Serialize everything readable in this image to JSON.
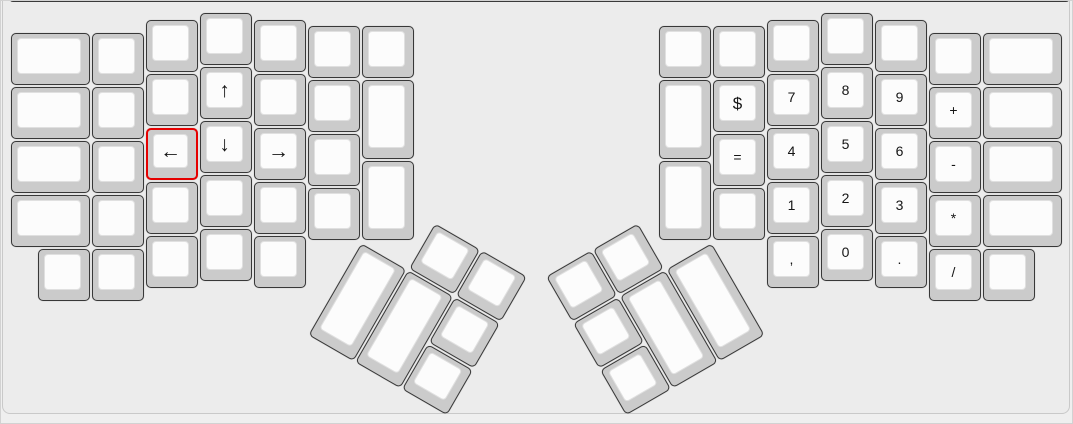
{
  "app": {
    "description_label": "ergodox-keyboard-layout-canvas",
    "selected_key_label": "←"
  },
  "colors": {
    "page_bg": "#efefef",
    "canvas_bg": "#ececec",
    "canvas_border": "#c9c9c9",
    "toolbar_edge_line": "#3a3a3a",
    "key_side": "#cbcbcb",
    "key_side_border": "#383838",
    "key_top": "#fcfcfc",
    "selection_red": "#e60000",
    "label_color": "#151515"
  },
  "keyboard": {
    "unit": 54,
    "main_keys": [
      {
        "x": 10,
        "y": 32,
        "w": 81
      },
      {
        "x": 10,
        "y": 86,
        "w": 81
      },
      {
        "x": 10,
        "y": 140,
        "w": 81
      },
      {
        "x": 10,
        "y": 194,
        "w": 81
      },
      {
        "x": 91,
        "y": 32
      },
      {
        "x": 91,
        "y": 86
      },
      {
        "x": 91,
        "y": 140
      },
      {
        "x": 91,
        "y": 194
      },
      {
        "x": 37,
        "y": 248
      },
      {
        "x": 91,
        "y": 248
      },
      {
        "x": 145,
        "y": 19
      },
      {
        "x": 145,
        "y": 73
      },
      {
        "x": 145,
        "y": 127,
        "label": "←",
        "name": "left-arrow",
        "size": "lg",
        "selected": true
      },
      {
        "x": 145,
        "y": 181
      },
      {
        "x": 145,
        "y": 235
      },
      {
        "x": 199,
        "y": 12
      },
      {
        "x": 199,
        "y": 66,
        "label": "↑",
        "name": "up-arrow",
        "size": "lg"
      },
      {
        "x": 199,
        "y": 120,
        "label": "↓",
        "name": "down-arrow",
        "size": "lg"
      },
      {
        "x": 199,
        "y": 174
      },
      {
        "x": 199,
        "y": 228
      },
      {
        "x": 253,
        "y": 19
      },
      {
        "x": 253,
        "y": 73
      },
      {
        "x": 253,
        "y": 127,
        "label": "→",
        "name": "right-arrow",
        "size": "lg"
      },
      {
        "x": 253,
        "y": 181
      },
      {
        "x": 253,
        "y": 235
      },
      {
        "x": 307,
        "y": 25
      },
      {
        "x": 307,
        "y": 79
      },
      {
        "x": 307,
        "y": 133
      },
      {
        "x": 307,
        "y": 187
      },
      {
        "x": 361,
        "y": 25
      },
      {
        "x": 361,
        "y": 79,
        "h": 81
      },
      {
        "x": 361,
        "y": 160,
        "h": 81
      },
      {
        "x": 658,
        "y": 25
      },
      {
        "x": 658,
        "y": 79,
        "h": 81
      },
      {
        "x": 658,
        "y": 160,
        "h": 81
      },
      {
        "x": 712,
        "y": 25
      },
      {
        "x": 712,
        "y": 79,
        "label": "$",
        "name": "dollar",
        "size": "md"
      },
      {
        "x": 712,
        "y": 133,
        "label": "=",
        "name": "equals"
      },
      {
        "x": 712,
        "y": 187
      },
      {
        "x": 766,
        "y": 19
      },
      {
        "x": 766,
        "y": 73,
        "label": "7",
        "name": "digit-7"
      },
      {
        "x": 766,
        "y": 127,
        "label": "4",
        "name": "digit-4"
      },
      {
        "x": 766,
        "y": 181,
        "label": "1",
        "name": "digit-1"
      },
      {
        "x": 766,
        "y": 235,
        "label": ",",
        "name": "comma"
      },
      {
        "x": 820,
        "y": 12
      },
      {
        "x": 820,
        "y": 66,
        "label": "8",
        "name": "digit-8"
      },
      {
        "x": 820,
        "y": 120,
        "label": "5",
        "name": "digit-5"
      },
      {
        "x": 820,
        "y": 174,
        "label": "2",
        "name": "digit-2"
      },
      {
        "x": 820,
        "y": 228,
        "label": "0",
        "name": "digit-0"
      },
      {
        "x": 874,
        "y": 19
      },
      {
        "x": 874,
        "y": 73,
        "label": "9",
        "name": "digit-9"
      },
      {
        "x": 874,
        "y": 127,
        "label": "6",
        "name": "digit-6"
      },
      {
        "x": 874,
        "y": 181,
        "label": "3",
        "name": "digit-3"
      },
      {
        "x": 874,
        "y": 235,
        "label": ".",
        "name": "period"
      },
      {
        "x": 928,
        "y": 32
      },
      {
        "x": 928,
        "y": 86,
        "label": "+",
        "name": "plus"
      },
      {
        "x": 928,
        "y": 140,
        "label": "-",
        "name": "minus"
      },
      {
        "x": 928,
        "y": 194,
        "label": "*",
        "name": "asterisk"
      },
      {
        "x": 928,
        "y": 248,
        "label": "/",
        "name": "slash"
      },
      {
        "x": 982,
        "y": 32,
        "w": 81
      },
      {
        "x": 982,
        "y": 86,
        "w": 81
      },
      {
        "x": 982,
        "y": 140,
        "w": 81
      },
      {
        "x": 982,
        "y": 194,
        "w": 81
      },
      {
        "x": 982,
        "y": 248
      }
    ],
    "thumb_clusters": [
      {
        "name": "thumb-cluster-left",
        "cx": 361,
        "cy": 241.5,
        "angle": 30,
        "keys": [
          {
            "x": 54,
            "y": -54
          },
          {
            "x": 108,
            "y": -54
          },
          {
            "x": 0,
            "y": 0,
            "h": 108
          },
          {
            "x": 54,
            "y": 0,
            "h": 108
          },
          {
            "x": 108,
            "y": 0
          },
          {
            "x": 108,
            "y": 54
          }
        ]
      },
      {
        "name": "thumb-cluster-right",
        "cx": 712,
        "cy": 241.5,
        "angle": -30,
        "keys": [
          {
            "x": -108,
            "y": -54
          },
          {
            "x": -162,
            "y": -54
          },
          {
            "x": -54,
            "y": 0,
            "h": 108
          },
          {
            "x": -108,
            "y": 0,
            "h": 108
          },
          {
            "x": -162,
            "y": 0
          },
          {
            "x": -162,
            "y": 54
          }
        ]
      }
    ]
  }
}
